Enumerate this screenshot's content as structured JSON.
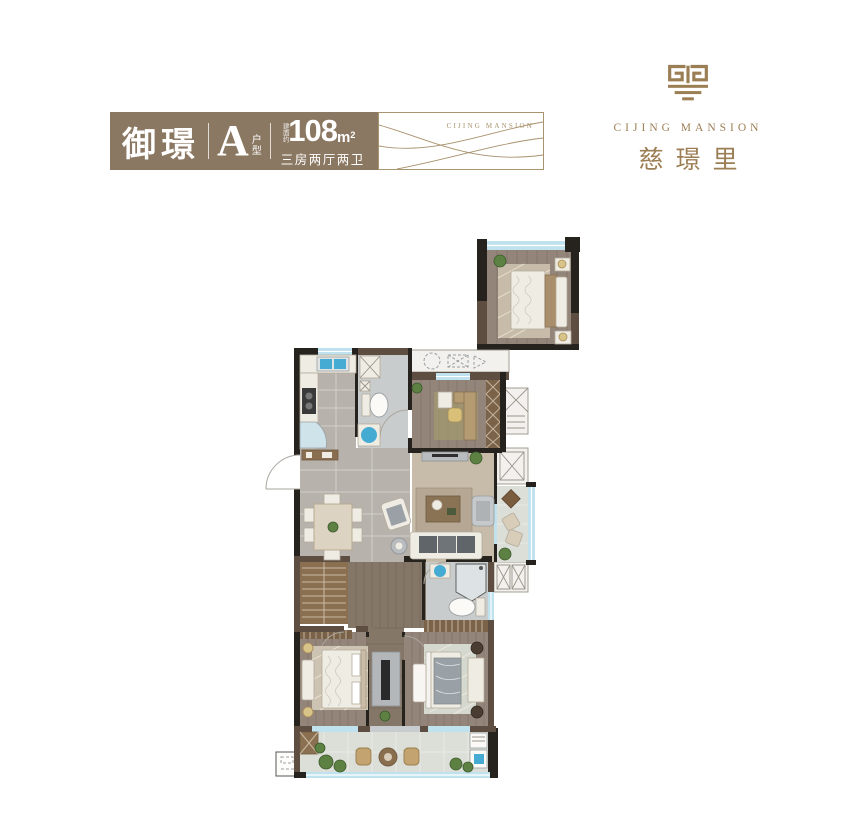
{
  "header": {
    "title": "御璟",
    "unit": {
      "letter": "A",
      "label_top": "户",
      "label_bottom": "型"
    },
    "area": {
      "prefix": "建面约",
      "value": "108",
      "unit": "m",
      "sup": "2",
      "rooms": "三房两厅两卫"
    },
    "wave_caption": "CIJING MANSION"
  },
  "logo": {
    "name_en": "CIJING MANSION",
    "name_cn": "慈璟里"
  },
  "colors": {
    "banner": "#8b7862",
    "gold": "#9c7e55",
    "gold_light": "#a9946f",
    "wall_dark": "#26231f",
    "wall_brown": "#5d4e41",
    "tile": "#b7b2ac",
    "tile_light": "#c9cccd",
    "wood": "#93857a",
    "wood_dark": "#857768",
    "carpet": "#c7bcaa",
    "balcony": "#dcded8",
    "window": "#bfe2ee",
    "fixture_blue": "#46abd2",
    "plant": "#5d8043",
    "furniture": "#efece4"
  }
}
